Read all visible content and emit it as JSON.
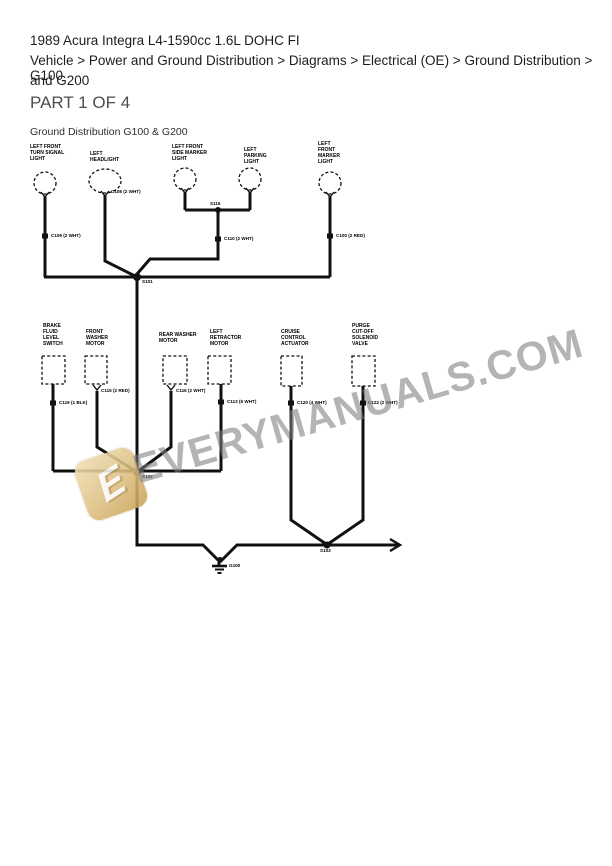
{
  "header": {
    "vehicle_title": "1989 Acura Integra L4-1590cc 1.6L DOHC FI",
    "breadcrumb_line1": "Vehicle > Power and Ground Distribution > Diagrams > Electrical (OE) > Ground Distribution > G100",
    "breadcrumb_line2": "and G200",
    "part_label": "PART 1 OF 4"
  },
  "diagram": {
    "title": "Ground Distribution G100 & G200",
    "wire_color": "#111111",
    "top_components": [
      {
        "label": "LEFT FRONT\nTURN SIGNAL\nLIGHT"
      },
      {
        "label": "LEFT\nHEADLIGHT"
      },
      {
        "label": "LEFT FRONT\nSIDE MARKER\nLIGHT"
      },
      {
        "label": "LEFT\nPARKING\nLIGHT"
      },
      {
        "label": "LEFT\nFRONT\nMARKER\nLIGHT"
      }
    ],
    "bottom_components": [
      {
        "label": "BRAKE\nFLUID\nLEVEL\nSWITCH"
      },
      {
        "label": "FRONT\nWASHER\nMOTOR"
      },
      {
        "label": "REAR WASHER\nMOTOR"
      },
      {
        "label": "LEFT\nRETRACTOR\nMOTOR"
      },
      {
        "label": "CRUISE\nCONTROL\nACTUATOR"
      },
      {
        "label": "PURGE\nCUT-OFF\nSOLENOID\nVALVE"
      }
    ],
    "connectors": {
      "c108": "C108 (2 WHT)",
      "c109": "C109 (2 WHT)",
      "c110": "C110 (2 WHT)",
      "c100": "C100 (2 RED)",
      "c119": "C119 (1 BLK)",
      "c115": "C115 (2 RED)",
      "c116": "C116 (2 WHT)",
      "c113": "C113 (6 WHT)",
      "c120": "C120 (4 WHT)",
      "c122": "C122 (2 WHT)"
    },
    "splices": {
      "s115": "S115",
      "s101": "S101",
      "s102": "S102",
      "s103": "S103"
    },
    "ground_label": "G100"
  },
  "watermark": {
    "text": "EVERYMANUALS.COM",
    "logo_letter": "E",
    "text_color": "#7d7d7d",
    "logo_color": "#d3ab5e"
  }
}
